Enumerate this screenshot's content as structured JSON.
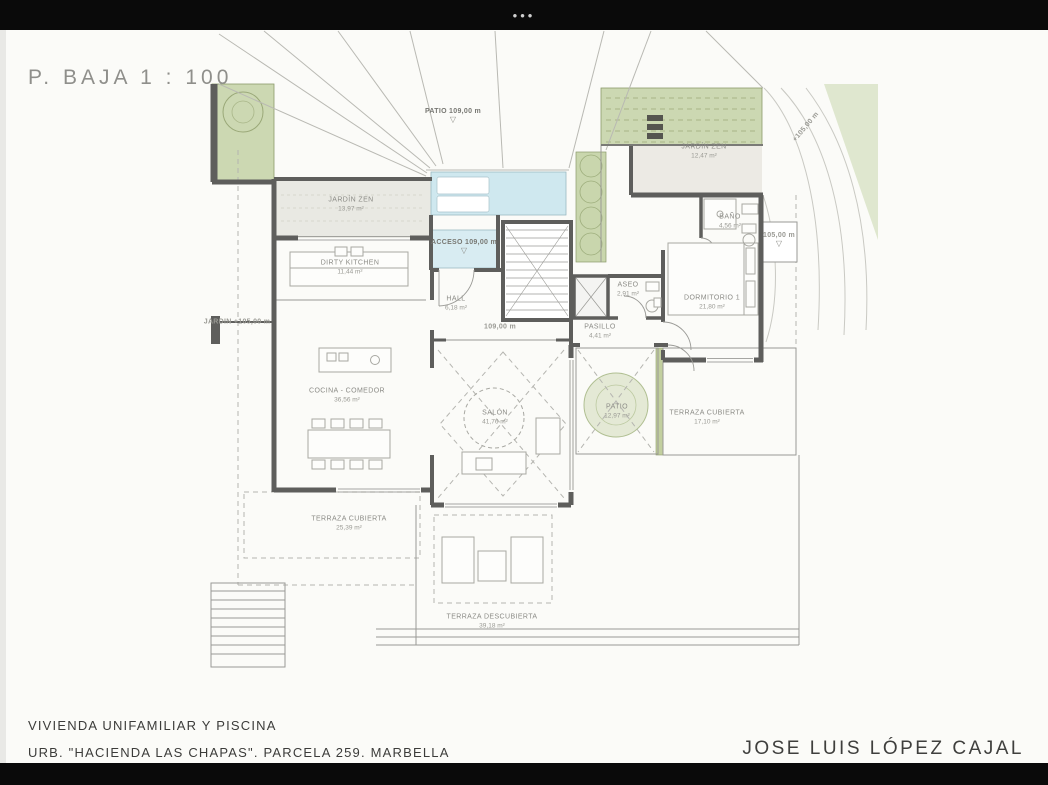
{
  "window": {
    "menu_dots": "•••"
  },
  "sheet": {
    "title": "P. BAJA  1 : 100",
    "footer_line1": "VIVIENDA UNIFAMILIAR Y PISCINA",
    "footer_line2": "URB. \"HACIENDA LAS CHAPAS\". PARCELA 259. MARBELLA",
    "architect": "JOSE LUIS LÓPEZ CAJAL"
  },
  "plan": {
    "rooms": {
      "jardin_zen_1": {
        "name": "JARDÍN ZEN",
        "area": "13,97 m²"
      },
      "dirty_kitchen": {
        "name": "DIRTY KITCHEN",
        "area": "11,44 m²"
      },
      "cocina": {
        "name": "COCINA - COMEDOR",
        "area": "36,56 m²"
      },
      "hall": {
        "name": "HALL",
        "area": "6,18 m²"
      },
      "salon": {
        "name": "SALÓN",
        "area": "41,76 m²"
      },
      "aseo": {
        "name": "ASEO",
        "area": "2,91 m²"
      },
      "pasillo": {
        "name": "PASILLO",
        "area": "4,41 m²"
      },
      "bano": {
        "name": "BAÑO",
        "area": "4,56 m²"
      },
      "dormitorio": {
        "name": "DORMITORIO 1",
        "area": "21,80 m²"
      },
      "jardin_zen_2": {
        "name": "JARDÍN ZEN",
        "area": "12,47 m²"
      },
      "patio_interior": {
        "name": "PATIO",
        "area": "12,97 m²"
      },
      "terraza_cubierta_1": {
        "name": "TERRAZA CUBIERTA",
        "area": "17,10 m²"
      },
      "terraza_cubierta_2": {
        "name": "TERRAZA CUBIERTA",
        "area": "25,39 m²"
      },
      "terraza_descubierta": {
        "name": "TERRAZA DESCUBIERTA",
        "area": "39,18 m²"
      }
    },
    "levels": {
      "patio_nivel": "PATIO 109,00 m",
      "acceso_nivel": "ACCESO 109,00 m",
      "stair_nivel": "109,00 m",
      "terraza_nivel": "105,00 m",
      "jardin_nivel": "JARDIN +105,00 m",
      "slope_nivel": "+105,00 m"
    }
  },
  "colors": {
    "garden_green": "#ccd8b2",
    "zen_gravel": "#e9e9e3",
    "pool_blue": "#cfe8ef",
    "wall_gray": "#5e5e5c",
    "line_gray": "#9a9a96",
    "letterbox_black": "#0a0a0a"
  }
}
